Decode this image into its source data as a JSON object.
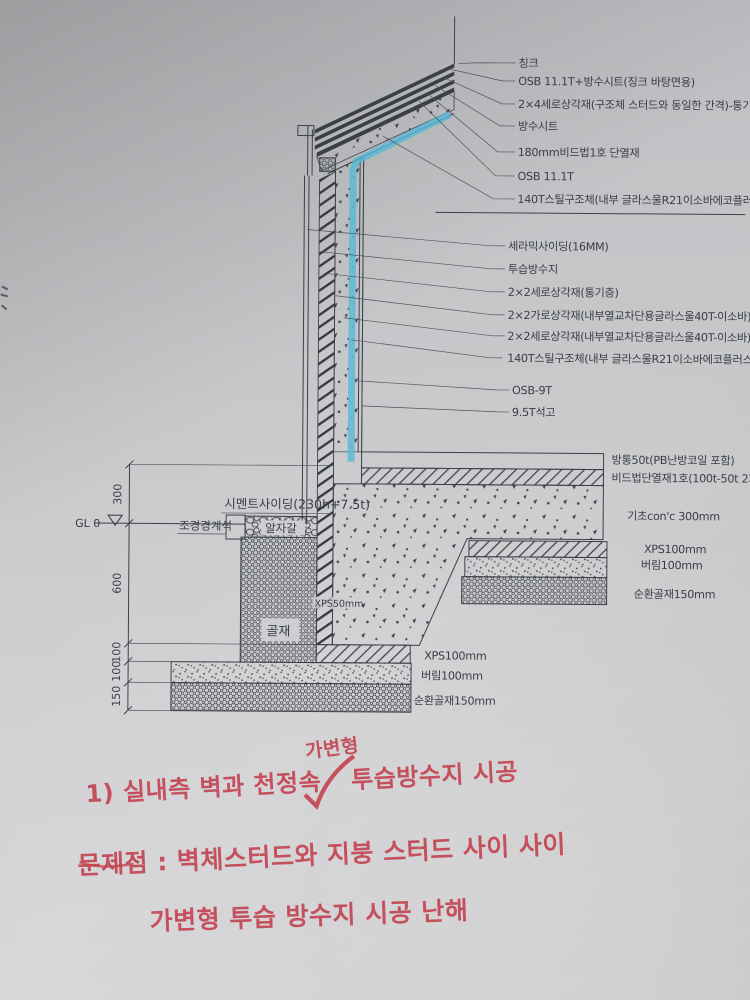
{
  "colors": {
    "line": "#3d4147",
    "paper": "#cbccce",
    "highlight": "#55b8d8",
    "handwriting": "#c44250"
  },
  "labels": {
    "roof": [
      "칭크",
      "OSB 11.1T+방수시트(징크 바탕면용)",
      "2×4세로상각재(구조체 스터드와 동일한 간격)-통기층",
      "방수시트",
      "180mm비드법1호 단열재",
      "OSB 11.1T",
      "140T스틸구조체(내부 글라스울R21이소바에코플러스)"
    ],
    "wall": [
      "세라믹사이딩(16MM)",
      "투습방수지",
      "2×2세로상각재(통기층)",
      "2×2가로상각재(내부열교차단용글라스울40T-이소바)",
      "2×2세로상각재(내부열교차단용글라스울40T-이소바)",
      "140T스틸구조체(내부 글라스울R21이소바에코플러스)",
      "OSB-9T",
      "9.5T석고"
    ],
    "slab": [
      "방통50t(PB난방코일 포함)",
      "비드법단열재1호(100t-50t 2회교차시공)"
    ],
    "foundation_right": [
      "기초con'c 300mm",
      "XPS100mm",
      "버림100mm",
      "순환골재150mm"
    ],
    "footing_left": [
      "XPS100mm",
      "버림100mm",
      "순환골재150mm"
    ],
    "site": {
      "cement_siding": "시멘트사이딩(230h+7.5t)",
      "boundary_stone": "조경경계석",
      "pebble": "알자갈",
      "aggregate": "골재",
      "xps50": "XPS50mm",
      "gl": "GL 0"
    },
    "dims": [
      "300",
      "600",
      "100",
      "100",
      "150"
    ]
  },
  "notes": {
    "superscript": "가변형",
    "line1_prefix": "1) 실내측 벽과 천정속",
    "line1_suffix": "투습방수지 시공",
    "line2": "문제점 : 벽체스터드와 지붕 스터드 사이 사이",
    "line3": "가변형  투습 방수지  시공  난해"
  }
}
